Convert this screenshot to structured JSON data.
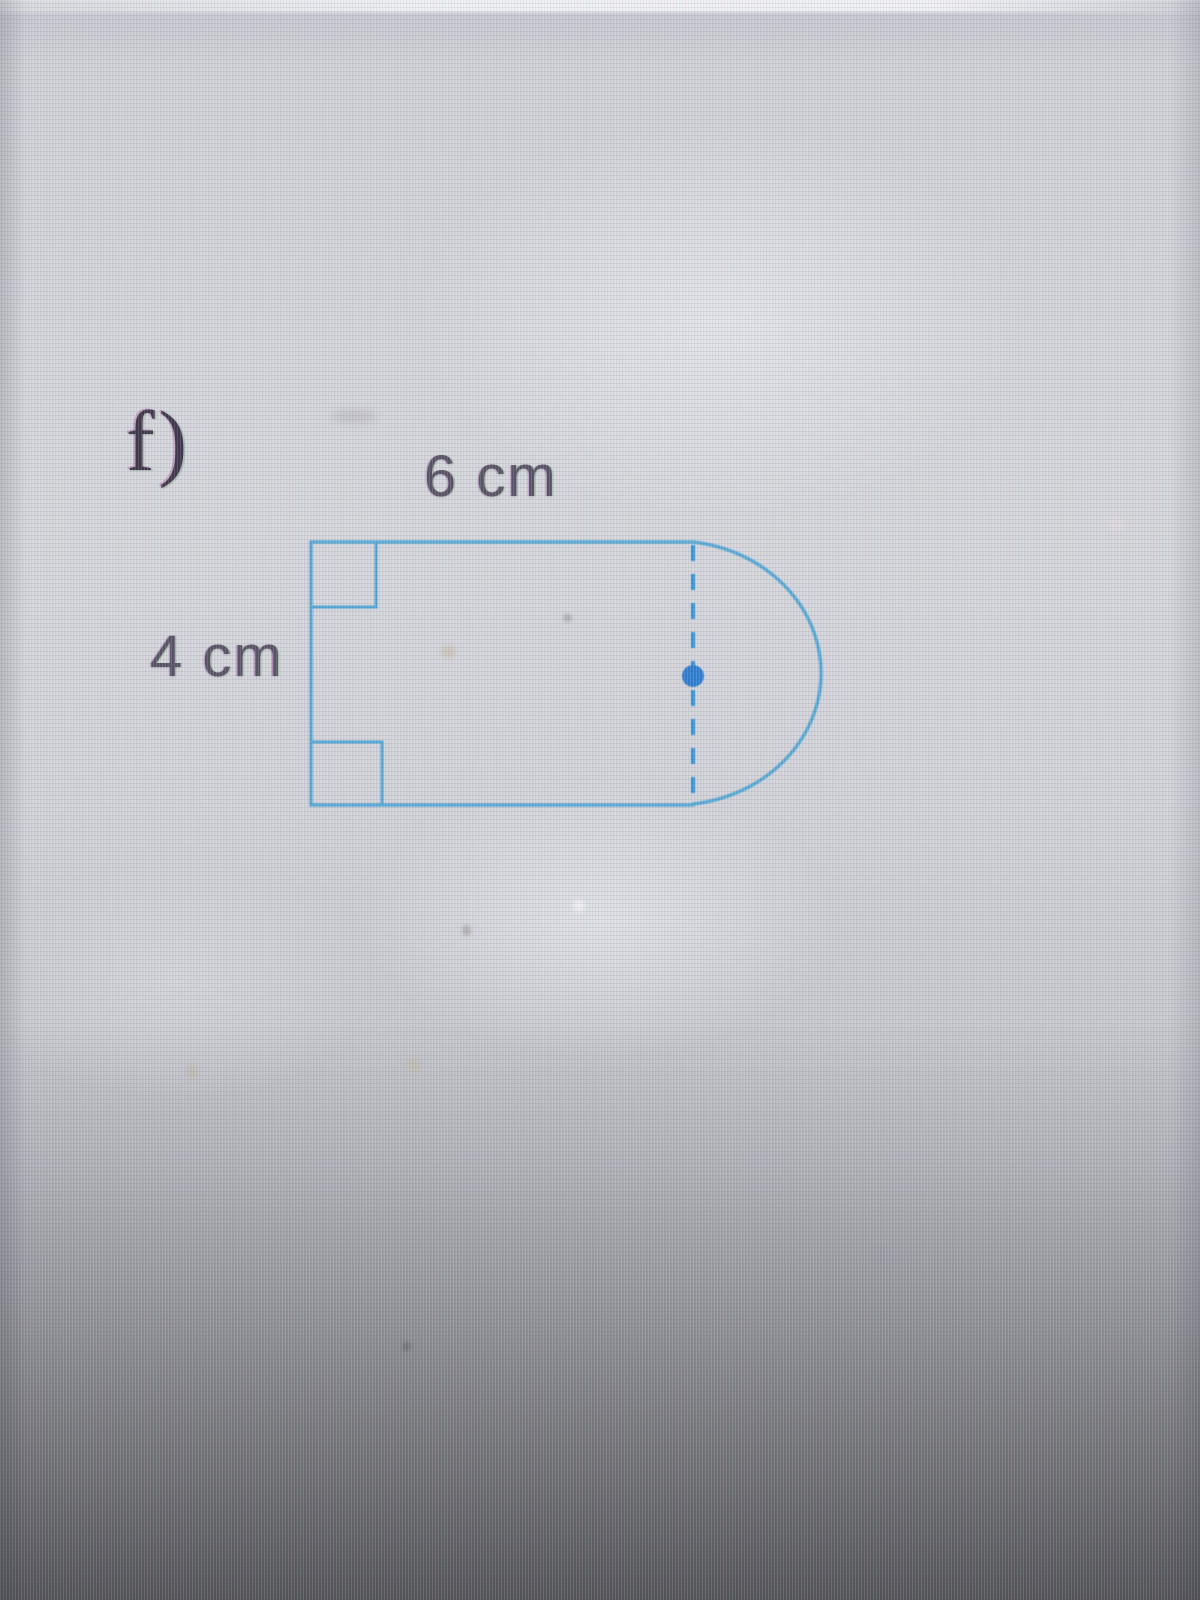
{
  "problem": {
    "label": "f)",
    "top_dimension": "6 cm",
    "left_dimension": "4 cm"
  },
  "figure": {
    "outline_color": "#55a9d7",
    "marker_color": "#4aa6d8",
    "dashed_color": "#2e93d6",
    "dot_color": "#2a7cd2"
  }
}
